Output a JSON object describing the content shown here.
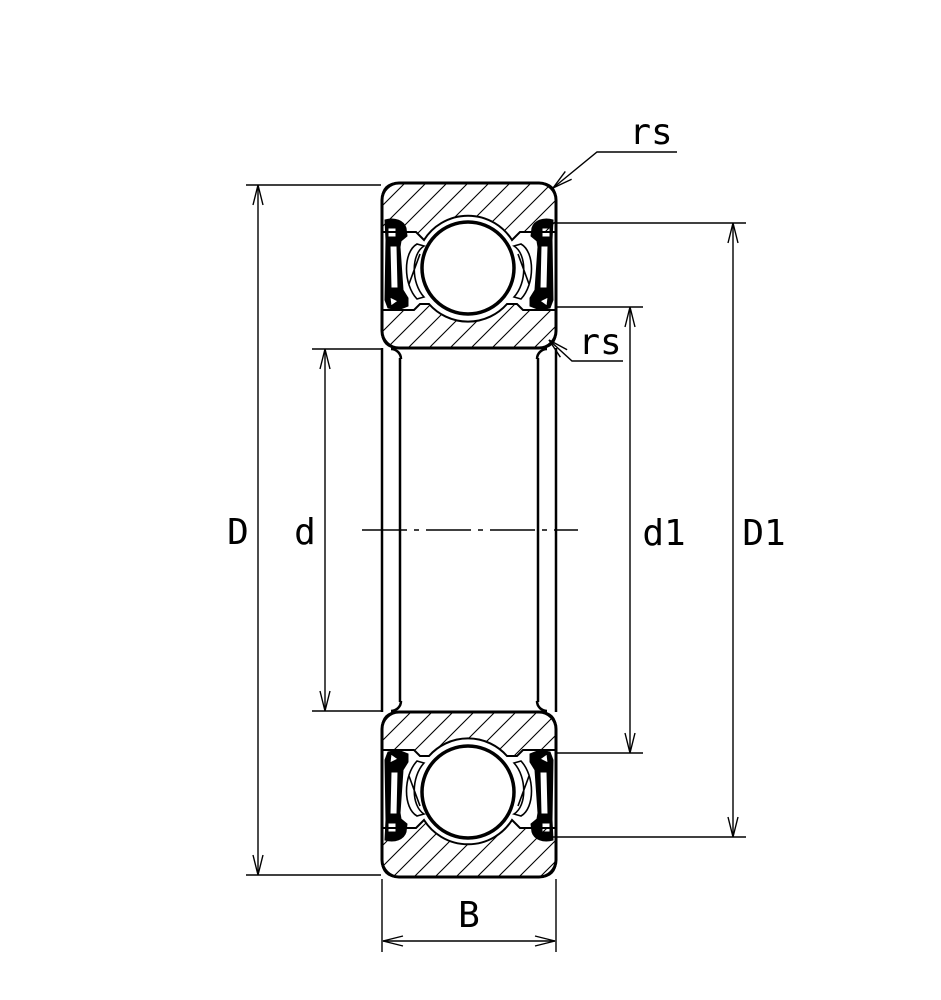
{
  "diagram": {
    "type": "deep-groove-ball-bearing-cross-section",
    "labels": {
      "outer_diameter": "D",
      "bore_diameter": "d",
      "shoulder_diameter_inner": "d1",
      "shoulder_diameter_outer": "D1",
      "width": "B",
      "chamfer_top": "rs",
      "chamfer_bottom": "rs"
    },
    "colors": {
      "line": "#000000",
      "background": "#ffffff"
    }
  }
}
